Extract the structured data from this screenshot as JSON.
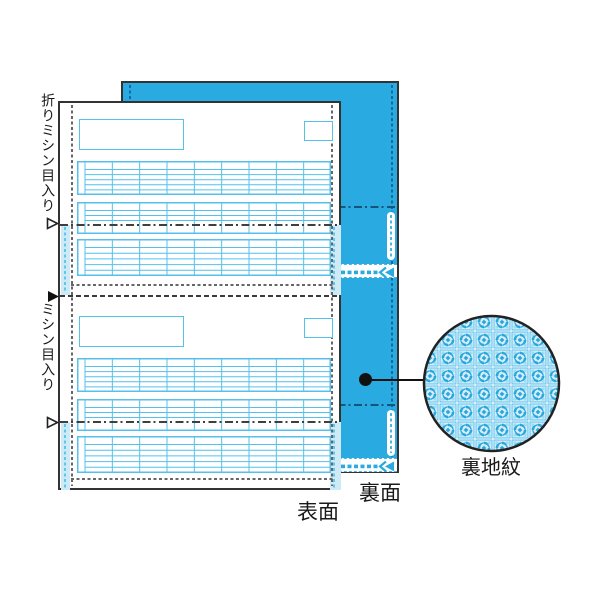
{
  "labels": {
    "fold_perforation": "折りミシン目入り",
    "perforation": "ミシン目入り",
    "front_side": "表面",
    "back_side": "裏面",
    "back_pattern": "裏地紋"
  },
  "colors": {
    "sheet_blue": "#29abe2",
    "sheet_blue_dash": "#0d6ba3",
    "grid_line": "#54c0eb",
    "stub_blue": "#cfeaf7",
    "pattern_bg": "#d7eefa",
    "pattern_motif": "#2aa8de",
    "outline_dark": "#333333",
    "dash_gray": "#666666",
    "text_black": "#1a1a1a"
  },
  "front_sheet": {
    "sections": 2,
    "grids": [
      {
        "name": "upper-table",
        "rows": 6,
        "cols": 9
      },
      {
        "name": "middle-table",
        "rows": 4,
        "cols": 9
      },
      {
        "name": "lower-table",
        "rows": 6,
        "cols": 9
      }
    ]
  },
  "icons": {
    "fold_arrow": "open-triangle-right",
    "cut_arrow": "filled-triangle-right",
    "tear_direction": "left-chevrons"
  }
}
